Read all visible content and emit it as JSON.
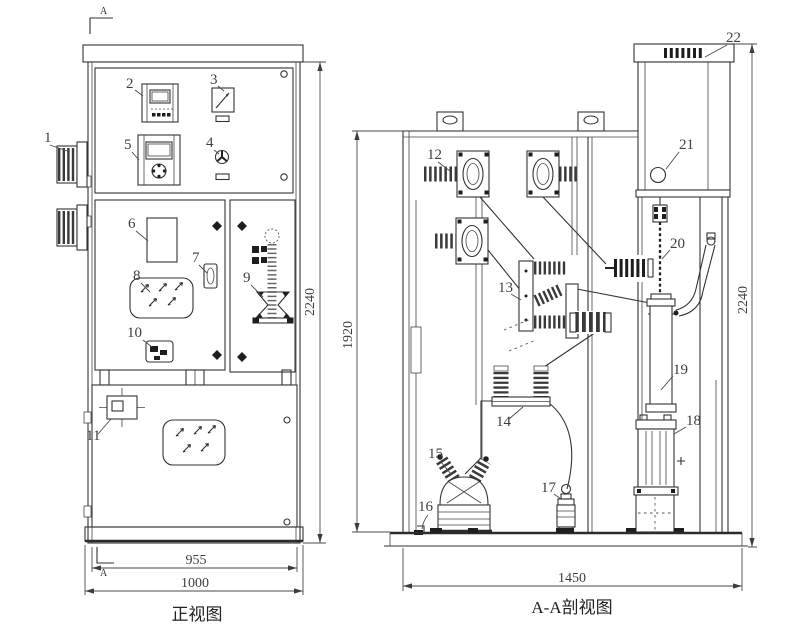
{
  "drawing": {
    "views": {
      "front_title": "正视图",
      "section_title": "A-A剖视图"
    },
    "section_marks": {
      "top": "A",
      "bottom": "A"
    },
    "callouts": {
      "c1": "1",
      "c2": "2",
      "c3": "3",
      "c4": "4",
      "c5": "5",
      "c6": "6",
      "c7": "7",
      "c8": "8",
      "c9": "9",
      "c10": "10",
      "c11": "11",
      "c12": "12",
      "c13": "13",
      "c14": "14",
      "c15": "15",
      "c16": "16",
      "c17": "17",
      "c18": "18",
      "c19": "19",
      "c20": "20",
      "c21": "21",
      "c22": "22"
    },
    "dimensions": {
      "front_height": "2240",
      "front_inner_width": "955",
      "front_width": "1000",
      "section_inner_height": "1920",
      "section_height": "2240",
      "section_width": "1450"
    },
    "colors": {
      "line": "#333333",
      "label": "#3f3f3f",
      "background": "#ffffff"
    }
  }
}
